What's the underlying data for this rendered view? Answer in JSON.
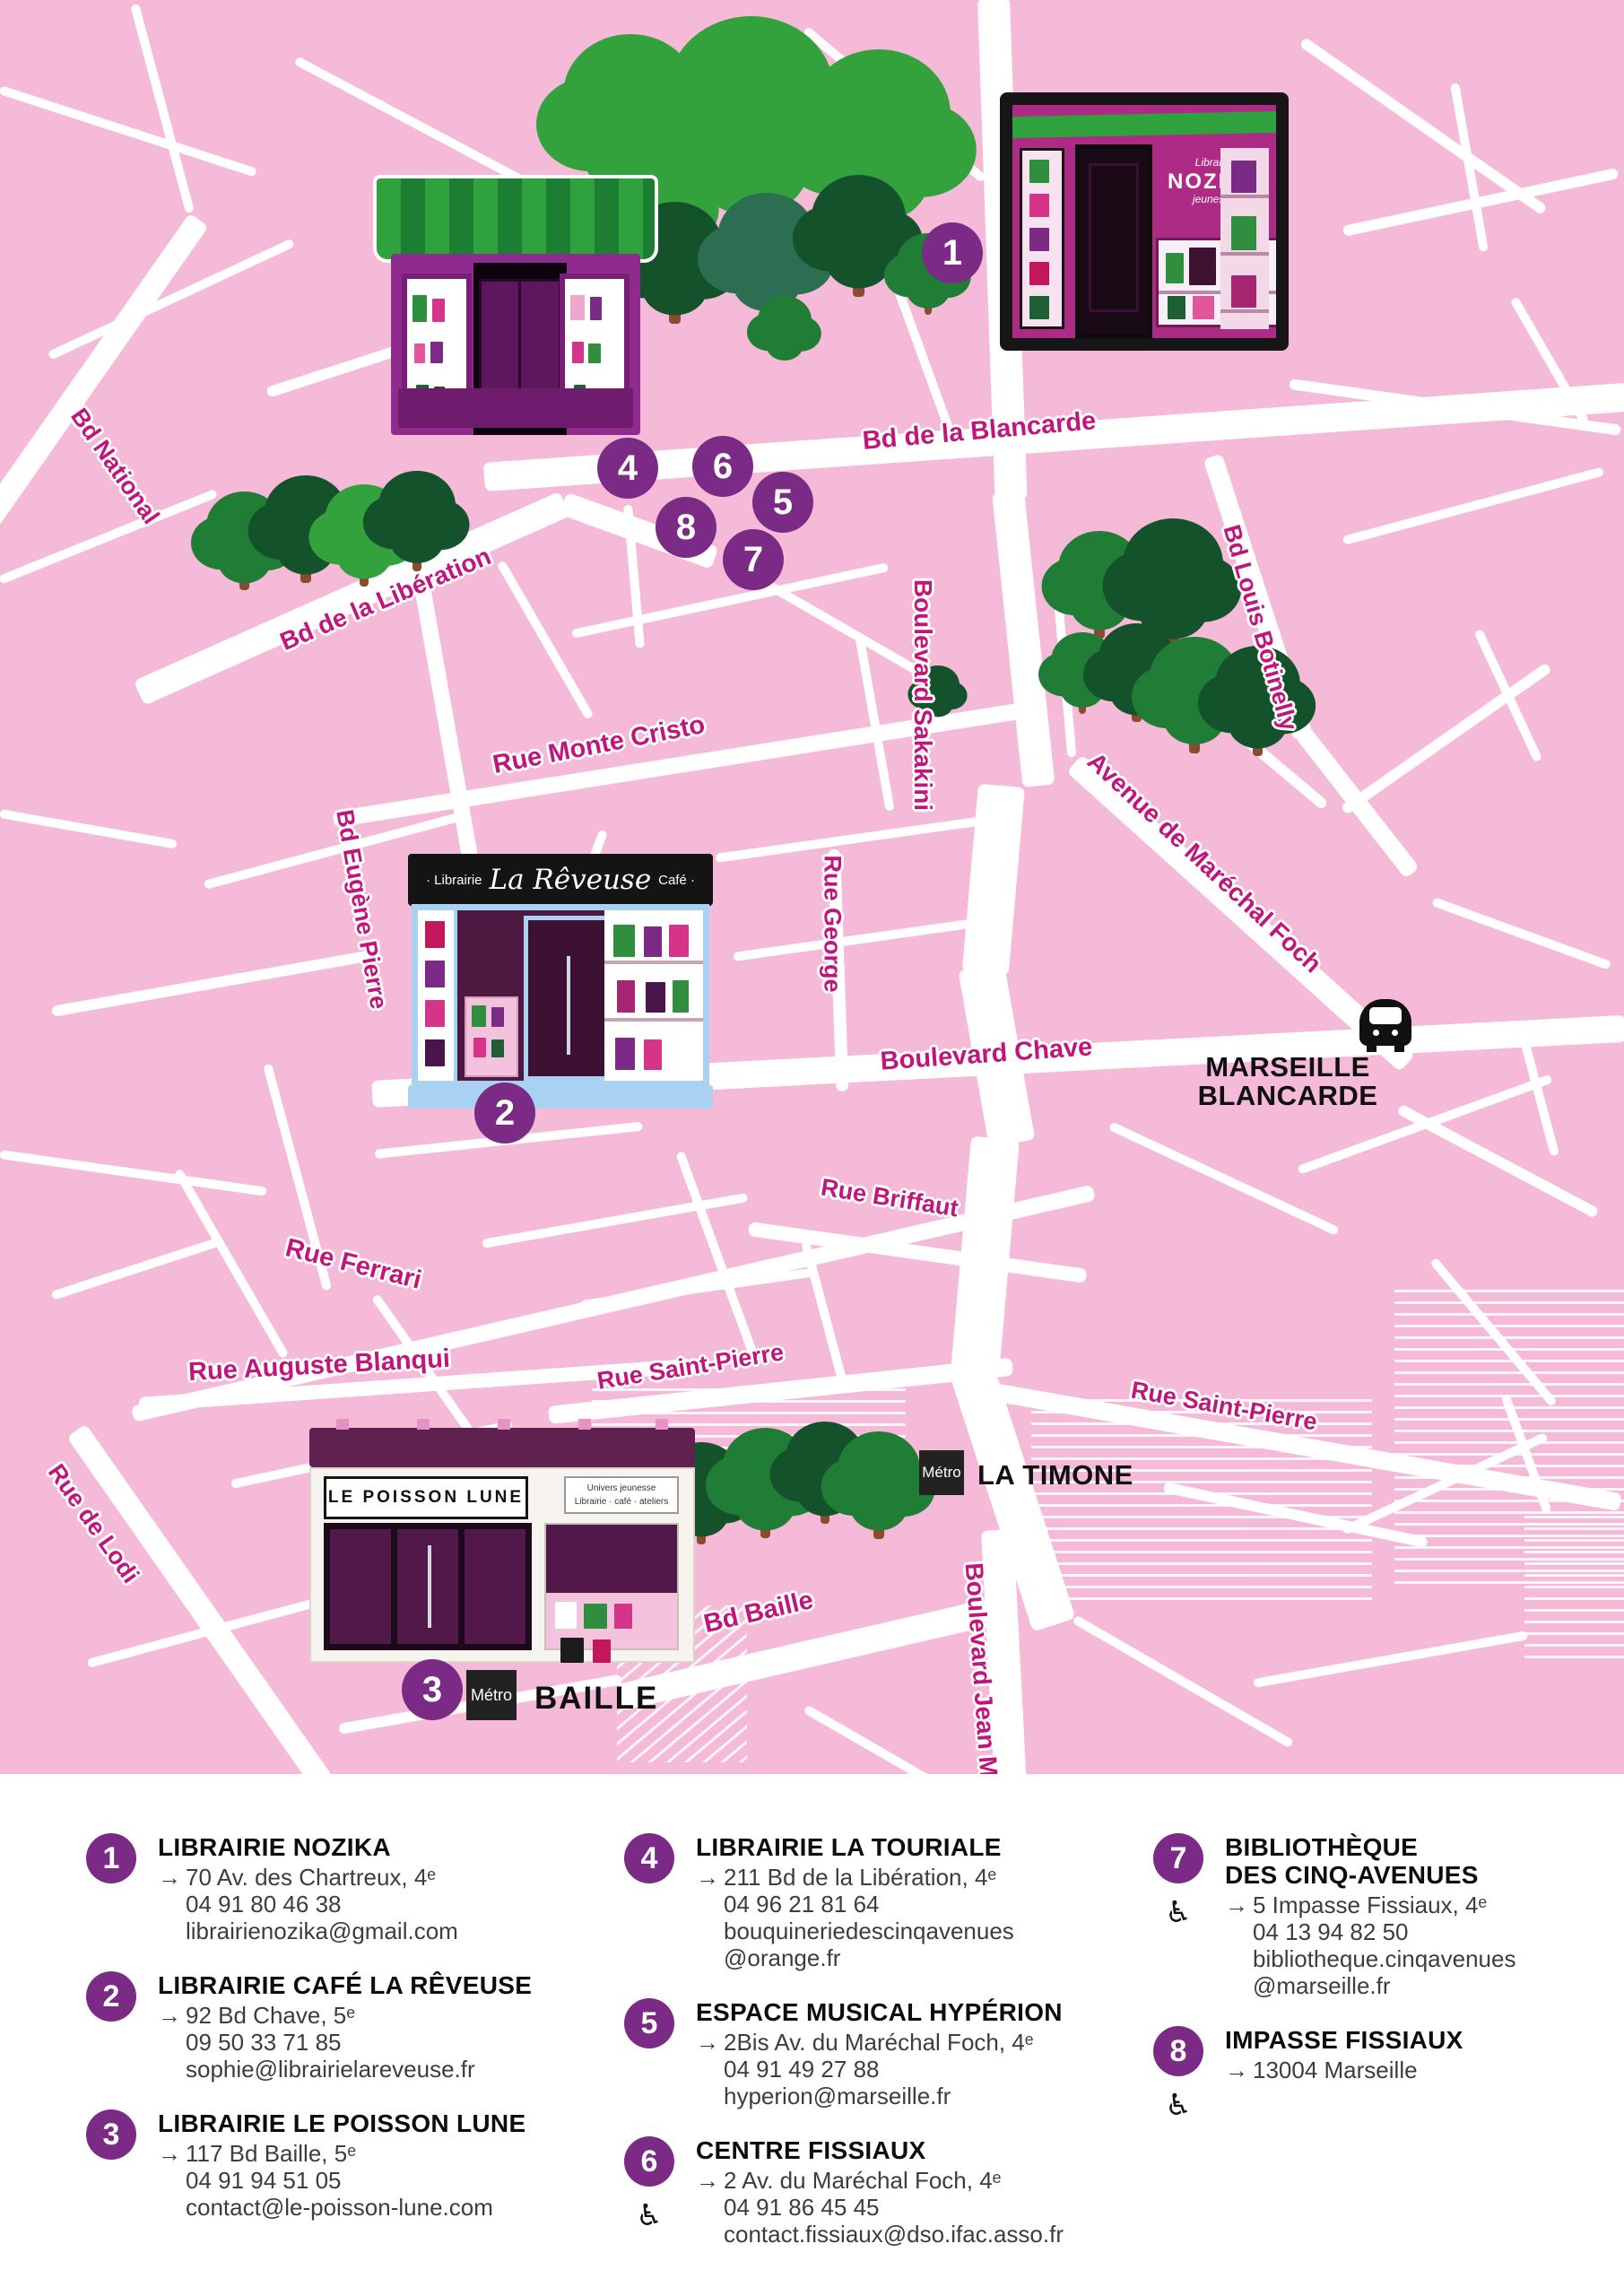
{
  "colors": {
    "map_pink": "#f5bad7",
    "road_white": "#ffffff",
    "street_label_magenta": "#c0157c",
    "marker_purple": "#7b2a85",
    "station_black": "#111111",
    "tree_green_light": "#33a23c",
    "tree_green_dark": "#14522c",
    "legend_text": "#3d3d3d"
  },
  "map": {
    "street_labels": [
      "Bd National",
      "Bd de la Libération",
      "Rue Monte Cristo",
      "Bd de la Blancarde",
      "Boulevard Sakakini",
      "Bd Louis Botinelly",
      "Avenue de Maréchal Foch",
      "Rue George",
      "Bd Eugène Pierre",
      "Boulevard Chave",
      "Rue Briffaut",
      "Rue Ferrari",
      "Rue Auguste Blanqui",
      "Rue Saint-Pierre",
      "Rue Saint-Pierre",
      "Rue de Lodi",
      "Bd Baille",
      "Boulevard Jean M"
    ],
    "markers": [
      "1",
      "2",
      "3",
      "4",
      "5",
      "6",
      "7",
      "8"
    ],
    "stations": {
      "blancarde_line1": "MARSEILLE",
      "blancarde_line2": "BLANCARDE",
      "timone": "LA TIMONE",
      "baille": "BAILLE",
      "metro_badge": "Métro"
    },
    "storefronts": {
      "nozika": {
        "top": "Librairie",
        "name": "NOZIKA",
        "bottom": "jeunesse"
      },
      "reveuse": {
        "left": "· Librairie",
        "name": "La Rêveuse",
        "right": "Café ·"
      },
      "poisson_lune": {
        "name": "LE POISSON LUNE",
        "sub1": "Univers jeunesse",
        "sub2": "Librairie · café · ateliers"
      }
    }
  },
  "legend": {
    "arrow": "→",
    "accessible_icon": "♿",
    "items": [
      {
        "num": "1",
        "title_lines": [
          "LIBRAIRIE NOZIKA"
        ],
        "accessible": false,
        "detail_lines": [
          "70 Av. des Chartreux, 4ᵉ",
          "04 91 80 46 38",
          "librairienozika@gmail.com"
        ]
      },
      {
        "num": "2",
        "title_lines": [
          "LIBRAIRIE CAFÉ LA RÊVEUSE"
        ],
        "accessible": false,
        "detail_lines": [
          "92 Bd Chave, 5ᵉ",
          "09 50 33 71 85",
          "sophie@librairielareveuse.fr"
        ]
      },
      {
        "num": "3",
        "title_lines": [
          "LIBRAIRIE LE POISSON LUNE"
        ],
        "accessible": false,
        "detail_lines": [
          "117 Bd Baille, 5ᵉ",
          "04 91 94 51 05",
          "contact@le-poisson-lune.com"
        ]
      },
      {
        "num": "4",
        "title_lines": [
          "LIBRAIRIE LA TOURIALE"
        ],
        "accessible": false,
        "detail_lines": [
          "211 Bd de la Libération, 4ᵉ",
          "04 96 21 81 64",
          "bouquineriedescinqavenues",
          "@orange.fr"
        ]
      },
      {
        "num": "5",
        "title_lines": [
          "ESPACE MUSICAL HYPÉRION"
        ],
        "accessible": false,
        "detail_lines": [
          "2Bis Av. du Maréchal Foch, 4ᵉ",
          "04 91 49 27 88",
          "hyperion@marseille.fr"
        ]
      },
      {
        "num": "6",
        "title_lines": [
          "CENTRE FISSIAUX"
        ],
        "accessible": true,
        "detail_lines": [
          "2 Av. du Maréchal Foch, 4ᵉ",
          "04 91 86 45 45",
          "contact.fissiaux@dso.ifac.asso.fr"
        ]
      },
      {
        "num": "7",
        "title_lines": [
          "BIBLIOTHÈQUE",
          "DES CINQ-AVENUES"
        ],
        "accessible": true,
        "detail_lines": [
          "5 Impasse Fissiaux, 4ᵉ",
          "04 13 94 82 50",
          "bibliotheque.cinqavenues",
          "@marseille.fr"
        ]
      },
      {
        "num": "8",
        "title_lines": [
          "IMPASSE FISSIAUX"
        ],
        "accessible": true,
        "detail_lines": [
          "13004 Marseille"
        ]
      }
    ],
    "columns": [
      [
        0,
        1,
        2
      ],
      [
        3,
        4,
        5
      ],
      [
        6,
        7
      ]
    ]
  }
}
